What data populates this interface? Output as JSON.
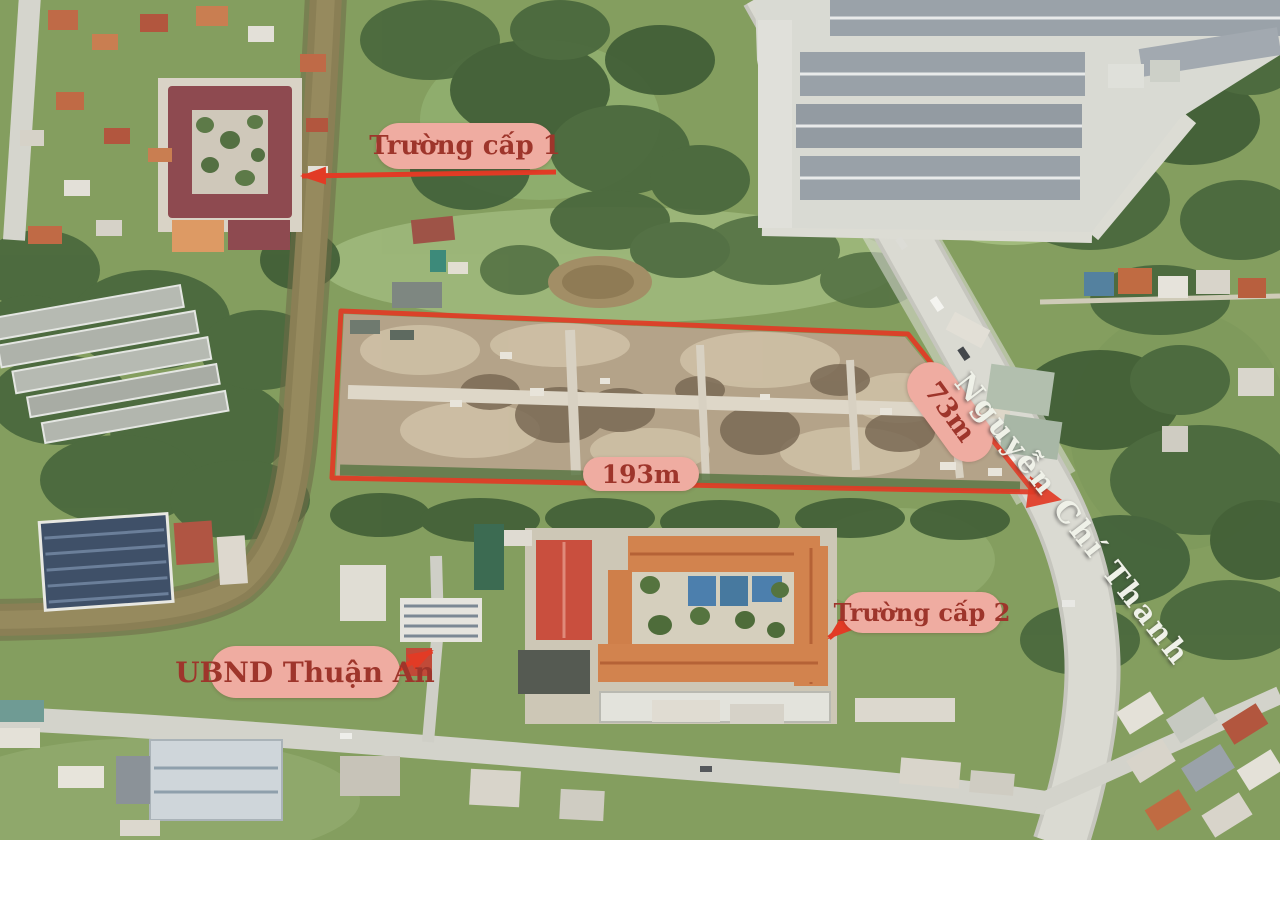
{
  "annotations": {
    "school1": {
      "label": "Trường cấp 1"
    },
    "school2": {
      "label": "Trường cấp 2"
    },
    "ubnd": {
      "label": "UBND Thuận An"
    },
    "road": {
      "name": "Nguyễn Chí Thanh"
    },
    "plot": {
      "width_label": "193m",
      "depth_label": "73m"
    }
  },
  "colors": {
    "annotation_red": "#e23b25",
    "label_bg": "#efaca1",
    "label_text": "#9e352b",
    "road_text": "#eff1e8"
  }
}
